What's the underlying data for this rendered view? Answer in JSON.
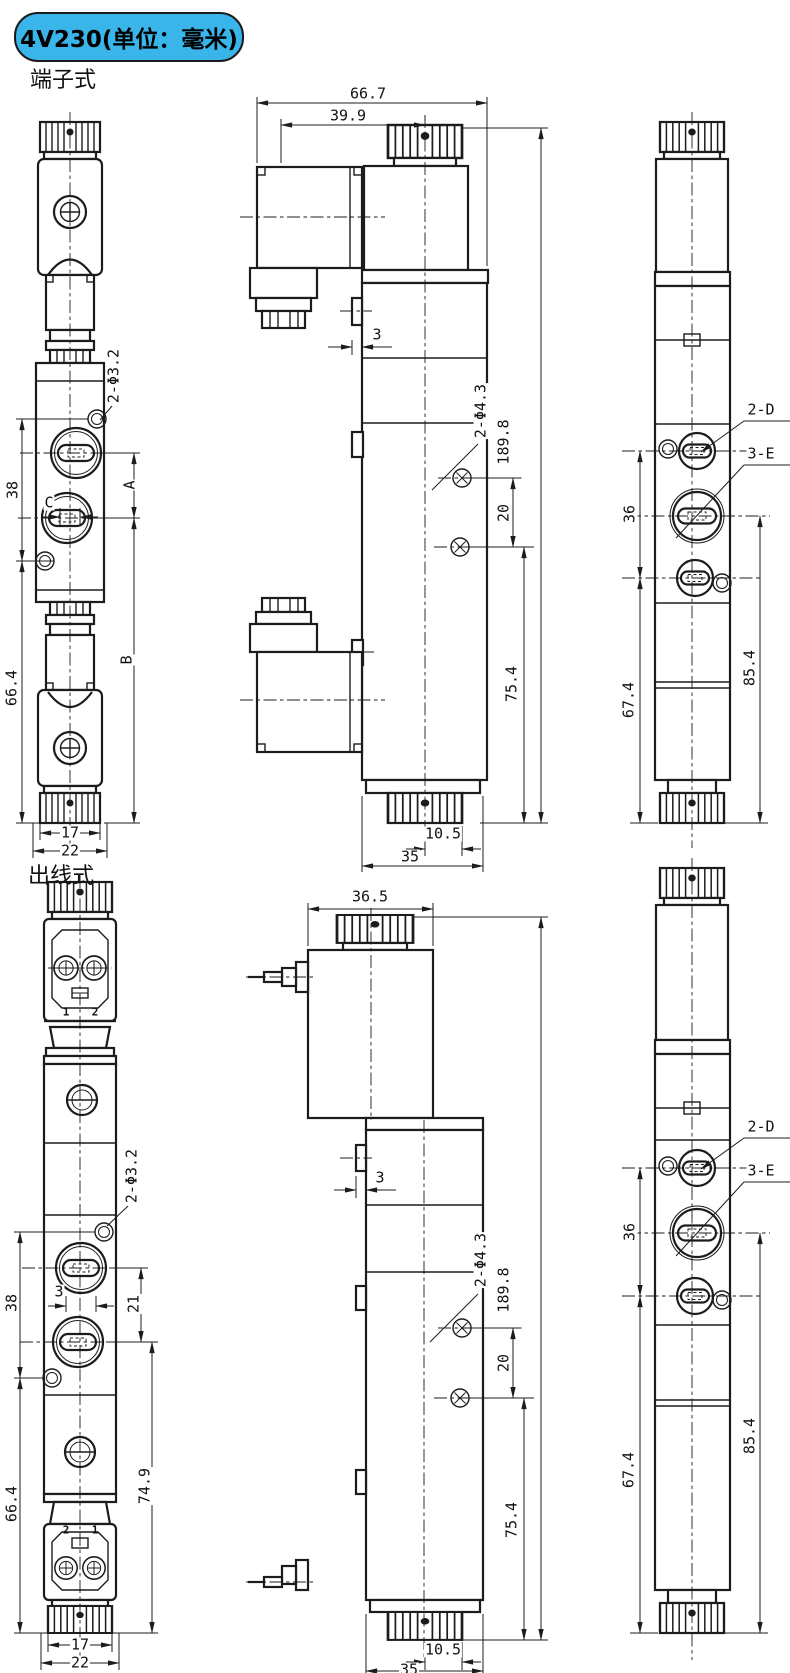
{
  "header": {
    "badge": "4V230(单位：毫米)"
  },
  "sections": {
    "terminal": "端子式",
    "leadwire": "出线式"
  },
  "labels": {
    "g1_front": {
      "hole": "2-Φ3.2",
      "d38": "38",
      "dA": "A",
      "dB": "B",
      "dC": "C",
      "d66": "66.4",
      "d17": "17",
      "d22": "22"
    },
    "g1_side": {
      "d667": "66.7",
      "d399": "39.9",
      "d3": "3",
      "hole": "2-Φ4.3",
      "d1898": "189.8",
      "d20": "20",
      "d754": "75.4",
      "d105": "10.5",
      "d35": "35"
    },
    "g1_right": {
      "pd": "2-D",
      "pe": "3-E",
      "d36": "36",
      "d674": "67.4",
      "d854": "85.4"
    },
    "g2_front": {
      "t1": "1",
      "t2": "2",
      "b2": "2",
      "b1": "1",
      "hole": "2-Φ3.2",
      "d38": "38",
      "d3": "3",
      "d21": "21",
      "d66": "66.4",
      "d749": "74.9",
      "d17": "17",
      "d22": "22"
    },
    "g2_side": {
      "d365": "36.5",
      "d3": "3",
      "hole": "2-Φ4.3",
      "d1898": "189.8",
      "d20": "20",
      "d754": "75.4",
      "d105": "10.5",
      "d35": "35"
    },
    "g2_right": {
      "pd": "2-D",
      "pe": "3-E",
      "d36": "36",
      "d674": "67.4",
      "d854": "85.4"
    }
  }
}
